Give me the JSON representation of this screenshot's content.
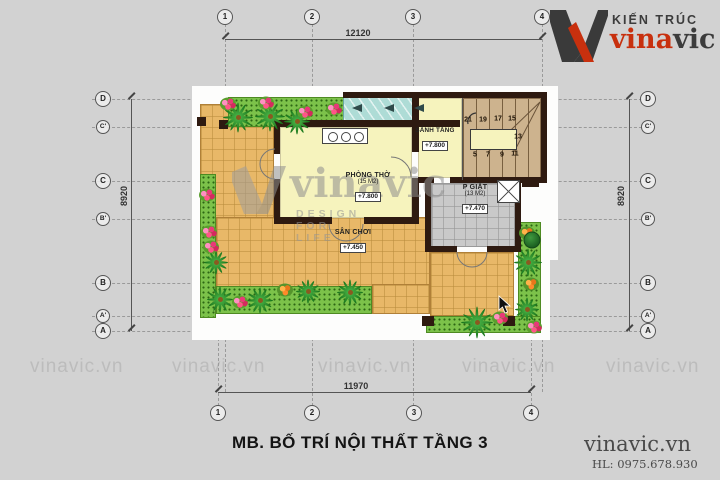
{
  "colors": {
    "background": "#d2d2d2",
    "brand_red": "#c8300e",
    "brand_dark": "#3c3c3c",
    "wall": "#2e1a10",
    "terrace_tile": "#e8b868",
    "room_floor": "#f6f3bd",
    "skylight": "#aedcd6",
    "grass": "#7cc24a",
    "laundry_tile": "#c9c9c9",
    "stair_tread": "#cdb38e",
    "watermark_gray": "#bcbcbc"
  },
  "logo": {
    "tagline": "KIẾN TRÚC",
    "brand_red": "vina",
    "brand_dark": "vic"
  },
  "footer": {
    "title": "MB. BỐ TRÍ NỘI THẤT TẦNG 3",
    "site": "vinavic.vn",
    "hotline": "HL: 0975.678.930"
  },
  "watermarks": {
    "tile_text": "vinavic.vn",
    "tile_positions_x": [
      30,
      172,
      318,
      462,
      606
    ],
    "center_text": "vinavic",
    "center_sub": "DESIGN FOR LIFE"
  },
  "grid": {
    "dim_top": "12120",
    "dim_bottom": "11970",
    "dim_left": "8920",
    "dim_right": "8920",
    "bubbles": [
      {
        "label": "1",
        "x": 225,
        "y": 17
      },
      {
        "label": "2",
        "x": 312,
        "y": 17
      },
      {
        "label": "3",
        "x": 413,
        "y": 17
      },
      {
        "label": "4",
        "x": 542,
        "y": 17
      },
      {
        "label": "1",
        "x": 218,
        "y": 413
      },
      {
        "label": "2",
        "x": 312,
        "y": 413
      },
      {
        "label": "3",
        "x": 414,
        "y": 413
      },
      {
        "label": "4",
        "x": 531,
        "y": 413
      },
      {
        "label": "D",
        "x": 103,
        "y": 99
      },
      {
        "label": "C'",
        "x": 103,
        "y": 127,
        "small": true
      },
      {
        "label": "C",
        "x": 103,
        "y": 181
      },
      {
        "label": "B'",
        "x": 103,
        "y": 219,
        "small": true
      },
      {
        "label": "B",
        "x": 103,
        "y": 283
      },
      {
        "label": "A'",
        "x": 103,
        "y": 316,
        "small": true
      },
      {
        "label": "A",
        "x": 103,
        "y": 331
      },
      {
        "label": "D",
        "x": 648,
        "y": 99
      },
      {
        "label": "C'",
        "x": 648,
        "y": 127,
        "small": true
      },
      {
        "label": "C",
        "x": 648,
        "y": 181
      },
      {
        "label": "B'",
        "x": 648,
        "y": 219,
        "small": true
      },
      {
        "label": "B",
        "x": 648,
        "y": 283
      },
      {
        "label": "A'",
        "x": 648,
        "y": 316,
        "small": true
      },
      {
        "label": "A",
        "x": 648,
        "y": 331
      }
    ]
  },
  "rooms": {
    "phong_tho": {
      "name": "PHÒNG THỜ",
      "area": "(15 M2)",
      "level": "+7.800"
    },
    "sanh_tang": {
      "name": "SẢNH TẦNG",
      "level": "+7.800"
    },
    "san_choi": {
      "name": "SÂN CHƠI",
      "level": "+7.450"
    },
    "p_giat": {
      "name": "P GIẶT",
      "area": "(13 M2)",
      "level": "+7.470"
    }
  },
  "stair_numbers": [
    {
      "t": "21",
      "x": 468,
      "y": 120
    },
    {
      "t": "19",
      "x": 483,
      "y": 120
    },
    {
      "t": "17",
      "x": 498,
      "y": 119
    },
    {
      "t": "15",
      "x": 512,
      "y": 119
    },
    {
      "t": "13",
      "x": 518,
      "y": 137
    },
    {
      "t": "11",
      "x": 515,
      "y": 154
    },
    {
      "t": "9",
      "x": 502,
      "y": 155
    },
    {
      "t": "7",
      "x": 488,
      "y": 155
    },
    {
      "t": "5",
      "x": 475,
      "y": 155
    }
  ],
  "plants": [
    {
      "k": "palm",
      "x": 238,
      "y": 117,
      "s": 15
    },
    {
      "k": "palm",
      "x": 270,
      "y": 116,
      "s": 15
    },
    {
      "k": "palm",
      "x": 297,
      "y": 121,
      "s": 13
    },
    {
      "k": "palm",
      "x": 216,
      "y": 262,
      "s": 12
    },
    {
      "k": "palm",
      "x": 220,
      "y": 299,
      "s": 13
    },
    {
      "k": "palm",
      "x": 260,
      "y": 300,
      "s": 13
    },
    {
      "k": "palm",
      "x": 308,
      "y": 291,
      "s": 12
    },
    {
      "k": "palm",
      "x": 350,
      "y": 292,
      "s": 13
    },
    {
      "k": "palm",
      "x": 477,
      "y": 322,
      "s": 16
    },
    {
      "k": "palm",
      "x": 528,
      "y": 262,
      "s": 14
    },
    {
      "k": "palm",
      "x": 527,
      "y": 309,
      "s": 12
    },
    {
      "k": "flower",
      "x": 228,
      "y": 104
    },
    {
      "k": "flower",
      "x": 266,
      "y": 103
    },
    {
      "k": "flower",
      "x": 305,
      "y": 112
    },
    {
      "k": "flower",
      "x": 334,
      "y": 109
    },
    {
      "k": "flower",
      "x": 207,
      "y": 195
    },
    {
      "k": "flower",
      "x": 209,
      "y": 232
    },
    {
      "k": "flower",
      "x": 211,
      "y": 247
    },
    {
      "k": "flower",
      "x": 240,
      "y": 302
    },
    {
      "k": "flower",
      "x": 500,
      "y": 318
    },
    {
      "k": "flower",
      "x": 534,
      "y": 327
    },
    {
      "k": "flower-orange",
      "x": 285,
      "y": 290
    },
    {
      "k": "flower-orange",
      "x": 531,
      "y": 284
    },
    {
      "k": "flower-orange",
      "x": 527,
      "y": 233
    },
    {
      "k": "bush",
      "x": 532,
      "y": 240
    }
  ]
}
